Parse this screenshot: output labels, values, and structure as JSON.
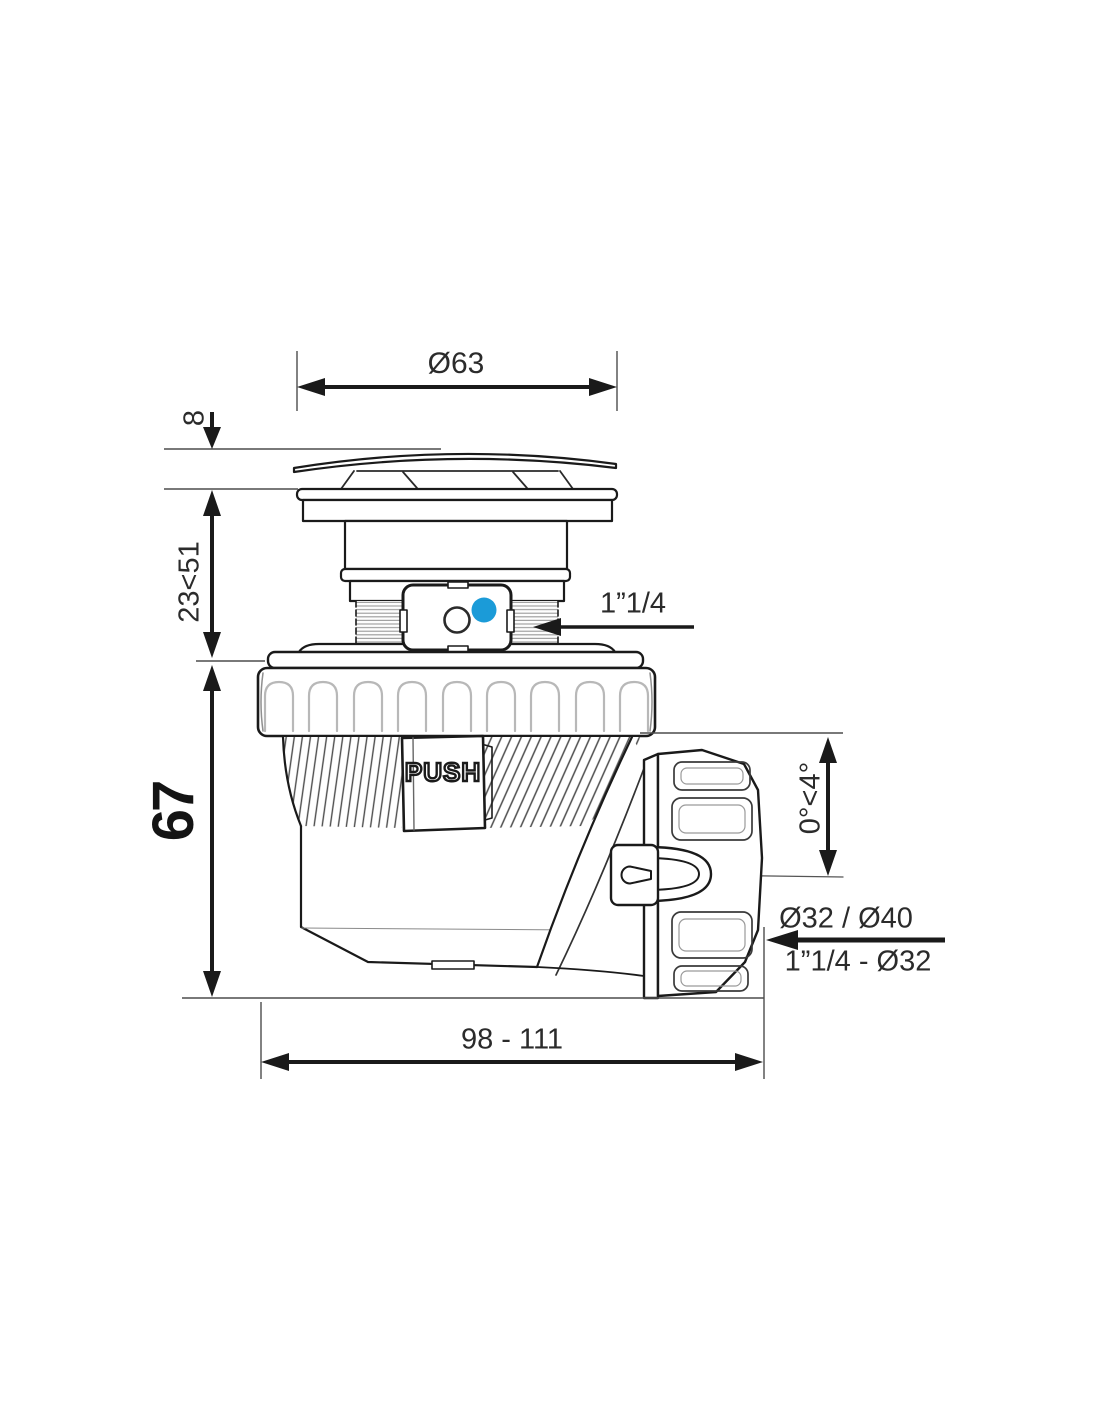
{
  "drawing": {
    "type": "technical-diagram",
    "subject": "push-open drain trap, side elevation with dimensions",
    "colors": {
      "line": "#1a1a1a",
      "thin_line": "#4d4d4d",
      "light_detail": "#b8b8b8",
      "accent_blue": "#1b9bd8",
      "background": "#ffffff"
    },
    "dimensions": {
      "top_diameter": "Ø63",
      "cap_height": "8",
      "adjustable_height": "23<51",
      "body_height": "67",
      "inlet_thread": "1”1/4",
      "angle_range": "0°<4°",
      "outlet_diameters": "Ø32 / Ø40",
      "outlet_thread": "1”1/4 - Ø32",
      "overall_length": "98 - 111"
    },
    "markings": {
      "push_button": "PUSH"
    }
  }
}
